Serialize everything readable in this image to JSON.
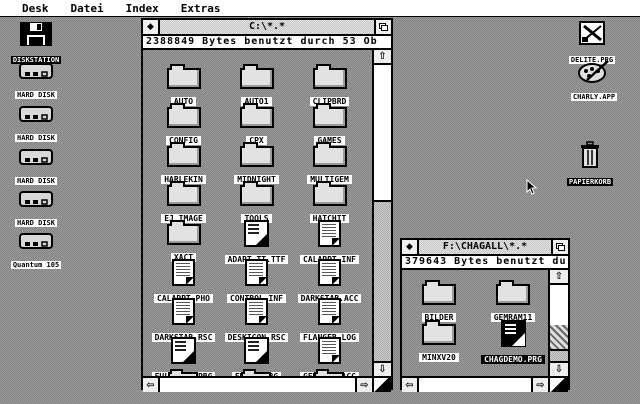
{
  "menu": {
    "items": [
      "Desk",
      "Datei",
      "Index",
      "Extras"
    ]
  },
  "glyphs": {
    "close": "◆",
    "up": "⇧",
    "down": "⇩",
    "left": "⇦",
    "right": "⇨"
  },
  "desktop_icons": {
    "left": [
      {
        "label": "DISKSTATION",
        "type": "floppy-drive",
        "selected": true
      },
      {
        "label": "HARD DISK",
        "type": "hard-disk"
      },
      {
        "label": "HARD DISK",
        "type": "hard-disk"
      },
      {
        "label": "HARD DISK",
        "type": "hard-disk"
      },
      {
        "label": "HARD DISK",
        "type": "hard-disk"
      },
      {
        "label": "Quantum 105",
        "type": "hard-disk"
      }
    ],
    "right": [
      {
        "label": "DELITE.PRG",
        "type": "program"
      },
      {
        "label": "CHARLY.APP",
        "type": "paint-accessory"
      },
      {
        "label": "PAPIERKORB",
        "type": "trash",
        "selected": true
      }
    ]
  },
  "window_c": {
    "title": "C:\\*.*",
    "info": "2388849 Bytes benutzt durch 53 Ob",
    "items": [
      {
        "label": "AUTO",
        "type": "folder"
      },
      {
        "label": "AUTO1",
        "type": "folder"
      },
      {
        "label": "CLIPBRD",
        "type": "folder"
      },
      {
        "label": "CONFIG",
        "type": "folder"
      },
      {
        "label": "CPX",
        "type": "folder"
      },
      {
        "label": "GAMES",
        "type": "folder"
      },
      {
        "label": "HARLEKIN",
        "type": "folder"
      },
      {
        "label": "MIDNIGHT",
        "type": "folder"
      },
      {
        "label": "MULTIGEM",
        "type": "folder"
      },
      {
        "label": "EJ_IMAGE",
        "type": "folder"
      },
      {
        "label": "TOOLS",
        "type": "folder"
      },
      {
        "label": "HATCHIT",
        "type": "folder"
      },
      {
        "label": "XACT",
        "type": "folder"
      },
      {
        "label": "ADAPT_TT.TTF",
        "type": "program-file"
      },
      {
        "label": "CALAPPT.INF",
        "type": "document"
      },
      {
        "label": "CALAPPT.PHO",
        "type": "document"
      },
      {
        "label": "CONTROL.INF",
        "type": "document"
      },
      {
        "label": "DARKSTAR.ACC",
        "type": "document"
      },
      {
        "label": "DARKSTAR.RSC",
        "type": "document"
      },
      {
        "label": "DESKICON.RSC",
        "type": "document"
      },
      {
        "label": "FLANGER.LOG",
        "type": "document"
      },
      {
        "label": "FULLSCRN.PRG",
        "type": "program-file"
      },
      {
        "label": "FULLX.PRG",
        "type": "program-file"
      },
      {
        "label": "GEMVIEW.ACC",
        "type": "document"
      }
    ]
  },
  "window_f": {
    "title": "F:\\CHAGALL\\*.*",
    "info": "379643 Bytes benutzt du",
    "items": [
      {
        "label": "BILDER",
        "type": "folder"
      },
      {
        "label": "GEMRAM11",
        "type": "folder"
      },
      {
        "label": "MINXV20",
        "type": "folder"
      },
      {
        "label": "CHAGDEMO.PRG",
        "type": "program-file",
        "selected": true
      }
    ]
  }
}
